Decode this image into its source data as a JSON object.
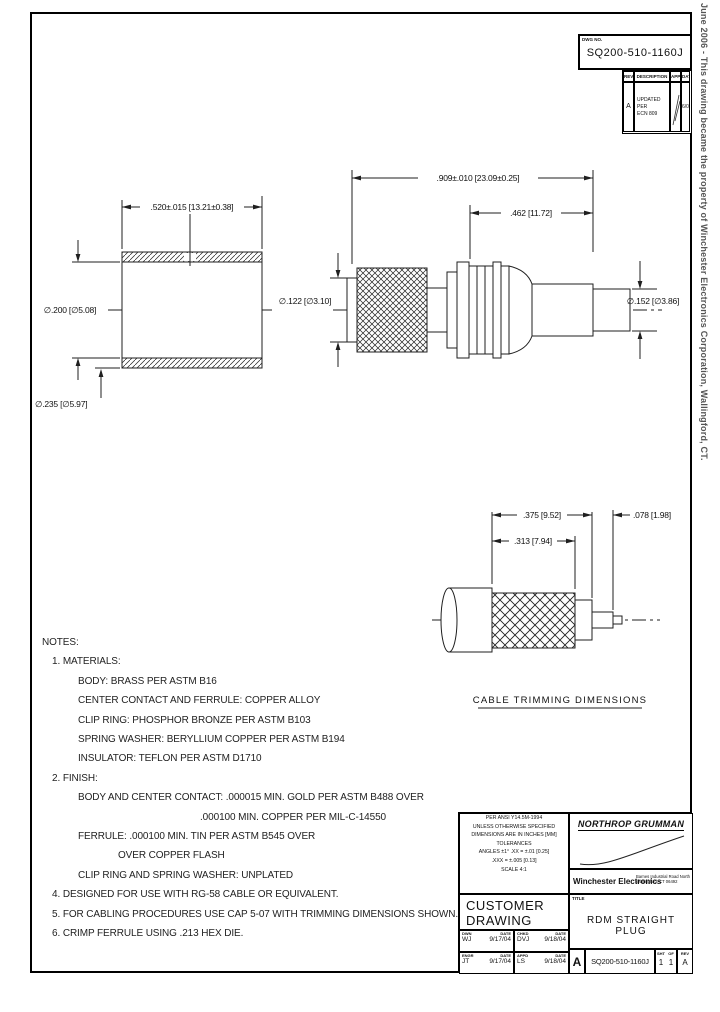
{
  "sheet": {
    "side_note": "June 2006 - This drawing became the property of Winchester Electronics Corporation, Wallingford, CT.",
    "dwg_no_label": "DWG NO.",
    "dwg_no": "SQ200-510-1160J"
  },
  "rev_table": {
    "headers": {
      "rev": "REV",
      "description": "DESCRIPTION",
      "app": "APP",
      "date": "DATE"
    },
    "row": {
      "rev": "A",
      "description_line1": "UPDATED PER",
      "description_line2": "ECN 809",
      "date": "6/06"
    }
  },
  "ferrule_view": {
    "length": ".520±.015 [13.21±0.38]",
    "bore": "∅.200 [∅5.08]",
    "od": "∅.235 [∅5.97]"
  },
  "connector_view": {
    "overall": ".909±.010 [23.09±0.25]",
    "body": ".462 [11.72]",
    "left_dia": "∅.122 [∅3.10]",
    "right_dia": "∅.152 [∅3.86]"
  },
  "cable_view": {
    "dim_375": ".375 [9.52]",
    "dim_078": ".078 [1.98]",
    "dim_313": ".313 [7.94]",
    "caption": "CABLE TRIMMING DIMENSIONS"
  },
  "notes": {
    "heading": "NOTES:",
    "lines": [
      {
        "text": "1. MATERIALS:",
        "indent": 1
      },
      {
        "text": "BODY: BRASS PER ASTM B16",
        "indent": 2
      },
      {
        "text": "CENTER CONTACT AND FERRULE: COPPER ALLOY",
        "indent": 2
      },
      {
        "text": "CLIP RING: PHOSPHOR BRONZE PER ASTM B103",
        "indent": 2
      },
      {
        "text": "SPRING WASHER: BERYLLIUM COPPER PER ASTM B194",
        "indent": 2
      },
      {
        "text": "INSULATOR: TEFLON PER ASTM D1710",
        "indent": 2
      },
      {
        "text": "2. FINISH:",
        "indent": 1
      },
      {
        "text": "BODY AND CENTER CONTACT: .000015 MIN. GOLD PER ASTM B488 OVER",
        "indent": 2
      },
      {
        "text": ".000100 MIN. COPPER PER MIL-C-14550",
        "indent": 4
      },
      {
        "text": "FERRULE: .000100 MIN. TIN PER ASTM B545 OVER",
        "indent": 2
      },
      {
        "text": "OVER COPPER FLASH",
        "indent": 3
      },
      {
        "text": "CLIP RING AND SPRING WASHER: UNPLATED",
        "indent": 2
      },
      {
        "text": "4. DESIGNED FOR USE WITH RG-58 CABLE OR EQUIVALENT.",
        "indent": 1
      },
      {
        "text": "5. FOR CABLING PROCEDURES USE CAP 5-07 WITH TRIMMING DIMENSIONS SHOWN.",
        "indent": 1
      },
      {
        "text": "6. CRIMP FERRULE USING .213 HEX DIE.",
        "indent": 1
      }
    ]
  },
  "title_block": {
    "tolerance_lines": [
      "PER ANSI Y14.5M-1994",
      "UNLESS OTHERWISE SPECIFIED",
      "DIMENSIONS ARE IN INCHES [MM]",
      "TOLERANCES",
      "ANGLES ±1°   .XX = ±.01 [0.25]",
      ".XXX = ±.005 [0.13]",
      "SCALE   4:1"
    ],
    "company": "NORTHROP GRUMMAN",
    "division": "Winchester Electronics",
    "address_line1": "Barnes Industrial Road North",
    "address_line2": "Wallingford, CT 06492",
    "drawing_type_line1": "CUSTOMER",
    "drawing_type_line2": "DRAWING",
    "title_label": "TITLE",
    "title": "RDM STRAIGHT PLUG",
    "signoff": [
      {
        "label": "DWN",
        "name": "WJ",
        "date_label": "DATE",
        "date": "9/17/04"
      },
      {
        "label": "CHKD",
        "name": "DVJ",
        "date_label": "DATE",
        "date": "9/18/04"
      },
      {
        "label": "ENGR",
        "name": "JT",
        "date_label": "DATE",
        "date": "9/17/04"
      },
      {
        "label": "APPD",
        "name": "LS",
        "date_label": "DATE",
        "date": "9/18/04"
      }
    ],
    "size": "A",
    "sheet_label": "SHT",
    "sheet": "1",
    "of_label": "OF",
    "of": "1",
    "rev_label": "REV",
    "rev": "A"
  }
}
